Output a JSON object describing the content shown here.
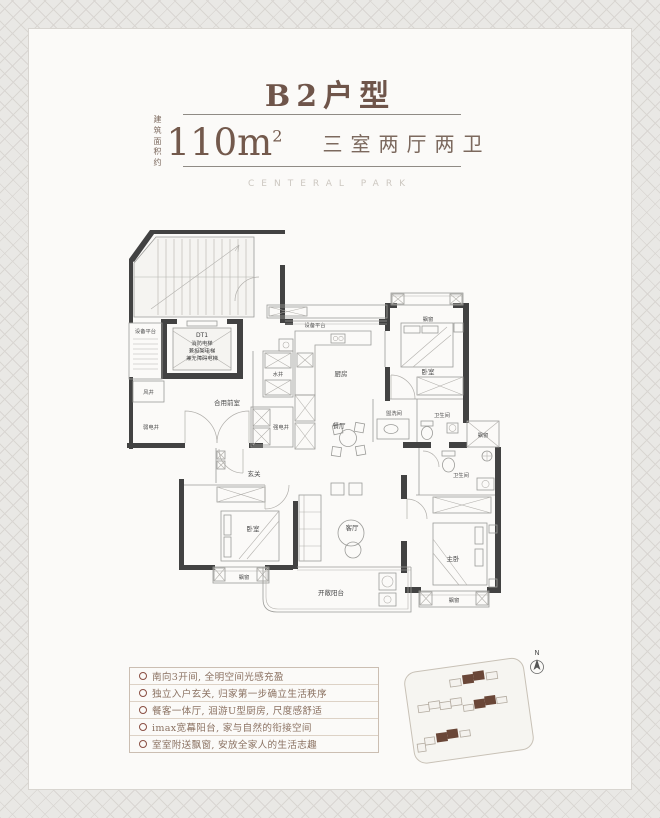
{
  "header": {
    "title": "B2户型",
    "area_label_line1": "建 筑",
    "area_label_line2": "面积约",
    "area_value": "110m",
    "area_sup": "2",
    "layout": "三室两厅两卫",
    "watermark": "CENTERAL PARK"
  },
  "floorplan": {
    "elevator_lines": [
      "DT1",
      "消防电梯",
      "兼担架电梯",
      "兼无障碍电梯"
    ],
    "rooms": {
      "equip_left": "设备平台",
      "wind_shaft": "风井",
      "weak_elec": "弱电井",
      "shared_lobby": "合用前室",
      "water_shaft": "水井",
      "strong_elec": "强电井",
      "equip_top": "设备平台",
      "kitchen": "厨房",
      "dining": "餐厅",
      "bay_top_right": "飘窗",
      "bedroom_top_right": "卧室",
      "washroom": "盥洗间",
      "bath_upper": "卫生间",
      "bay_right": "飘窗",
      "bath_lower": "卫生间",
      "foyer": "玄关",
      "bedroom_bottom_left": "卧室",
      "living": "客厅",
      "master": "主卧",
      "bay_bottom_left": "飘窗",
      "balcony": "开敞阳台",
      "bay_bottom_right": "飘窗"
    },
    "north_label": "N"
  },
  "features": {
    "items": [
      "南向3开间, 全明空间光感充盈",
      "独立入户玄关, 归家第一步确立生活秩序",
      "餐客一体厅, 洄游U型厨房, 尺度感舒适",
      "imax宽幕阳台, 家与自然的衔接空间",
      "室室附送飘窗, 安放全家人的生活志趣"
    ]
  },
  "colors": {
    "accent": "#6f554a",
    "wall": "#424242",
    "building_highlight": "#6a4738",
    "bullet": "#8a4f43"
  }
}
